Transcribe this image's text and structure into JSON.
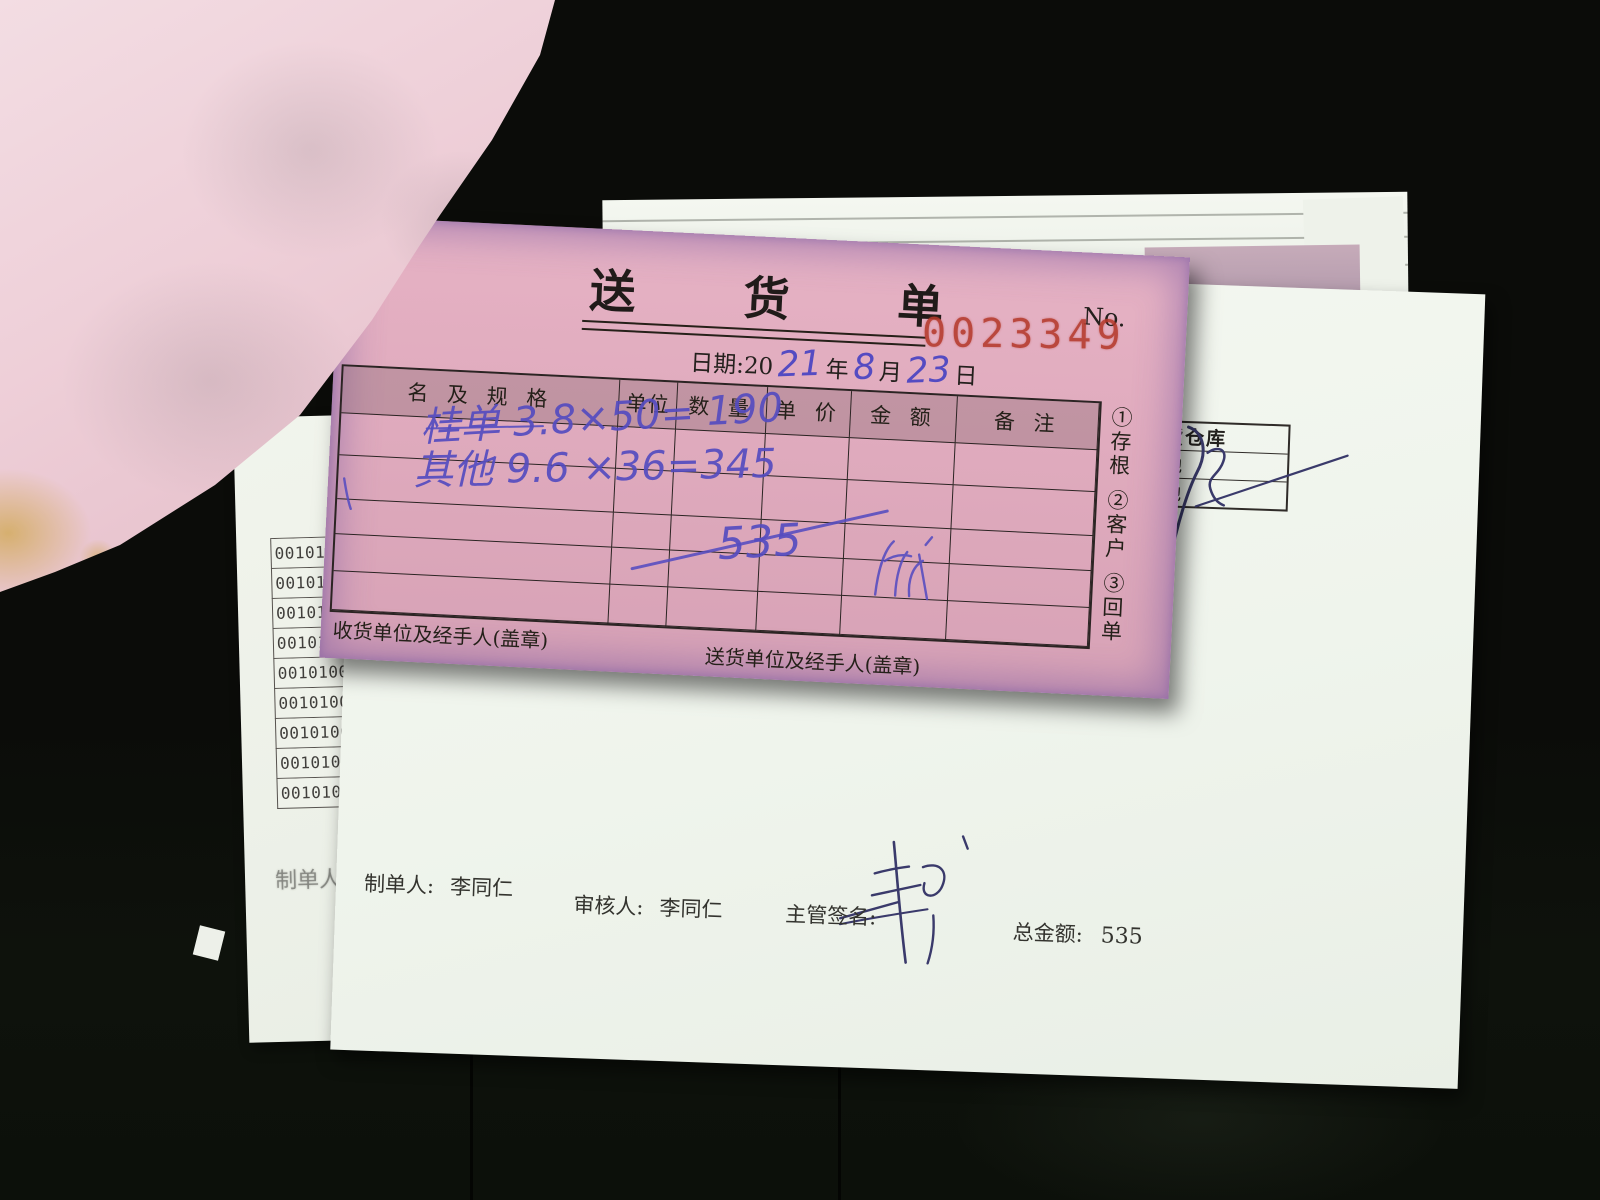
{
  "delivery_note": {
    "title": "送  货  单",
    "no_label": "No.",
    "no_value": "0023349",
    "date_line": {
      "prefix": "日期:20",
      "year_handwritten": "21",
      "year_unit": "年",
      "month_handwritten": "8",
      "month_unit": "月",
      "day_handwritten": "23",
      "day_unit": "日"
    },
    "table_headers": [
      "名 及 规 格",
      "单位",
      "数 量",
      "单 价",
      "金 额",
      "备 注"
    ],
    "items": [
      {
        "name_and_spec": "桂单 3.8×50= 190"
      },
      {
        "name_and_spec": "其他 9.6 ×36=345"
      }
    ],
    "quantity_total_handwritten": "535",
    "copy_labels": [
      "①存根",
      "②客户",
      "③回单"
    ],
    "receiver_footer": "收货单位及经手人(盖章)",
    "sender_footer": "送货单位及经手人(盖章)"
  },
  "under_sheet_right": {
    "warehouse_box_rows": [
      "货仓库",
      "池",
      "池"
    ],
    "footer": {
      "preparer_label": "制单人:",
      "preparer_name": "李同仁",
      "reviewer_label": "审核人:",
      "reviewer_name": "李同仁",
      "manager_sign_label": "主管签名:",
      "grand_total_label": "总金额:",
      "grand_total_value": "535"
    }
  },
  "under_sheet_left": {
    "ghost_preparer_label": "制单人:",
    "serial_numbers": [
      "00101008",
      "00101008",
      "00101008",
      "00101008",
      "00101008",
      "00101008",
      "00101008",
      "00101008",
      "00101008"
    ]
  },
  "colors": {
    "form_pink": "#dea9bc",
    "edge_purple": "#6e509e",
    "stamp_red": "#b5392b",
    "ink_blue": "#554cc0",
    "paper_white": "#f3f6ef",
    "background_dark": "#0b0c09"
  }
}
